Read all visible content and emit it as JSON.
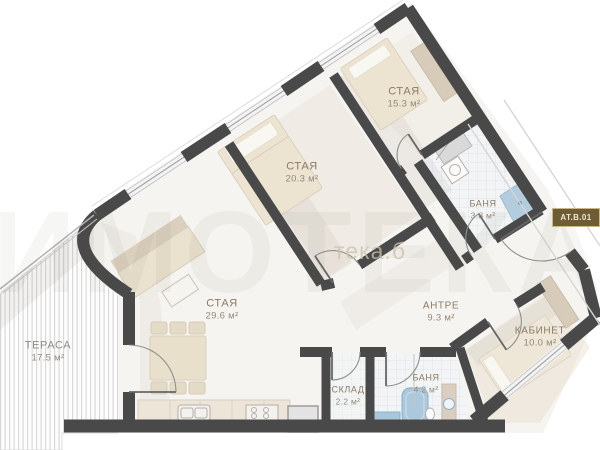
{
  "plan": {
    "unit_badge": "АТ.В.01",
    "watermark_big": "ИМОТЕКА",
    "watermark_small": "тека.б",
    "rooms": {
      "terrace": {
        "name": "ТЕРАСА",
        "area": "17.5 м²"
      },
      "living": {
        "name": "СТАЯ",
        "area": "29.6 м²"
      },
      "bedroom_mid": {
        "name": "СТАЯ",
        "area": "20.3 м²"
      },
      "bedroom_top": {
        "name": "СТАЯ",
        "area": "15.3 м²"
      },
      "bath_top": {
        "name": "БАНЯ",
        "area": "3.8 м²"
      },
      "hall": {
        "name": "АНТРЕ",
        "area": "9.3 м²"
      },
      "office": {
        "name": "КАБИНЕТ",
        "area": "10.0 м²"
      },
      "storage": {
        "name": "СКЛАД",
        "area": "2.2 м²"
      },
      "bath_bottom": {
        "name": "БАНЯ",
        "area": "4.2 м²"
      }
    },
    "colors": {
      "wall": "#494949",
      "floor": "#f6f4f0",
      "furniture_beige": "#eae1cf",
      "fixture_blue": "#abc8dc",
      "badge_bg": "#6e5c36",
      "badge_border": "#cbb87e",
      "badge_text": "#f0e6c8",
      "label_text": "#8c7b65"
    }
  }
}
